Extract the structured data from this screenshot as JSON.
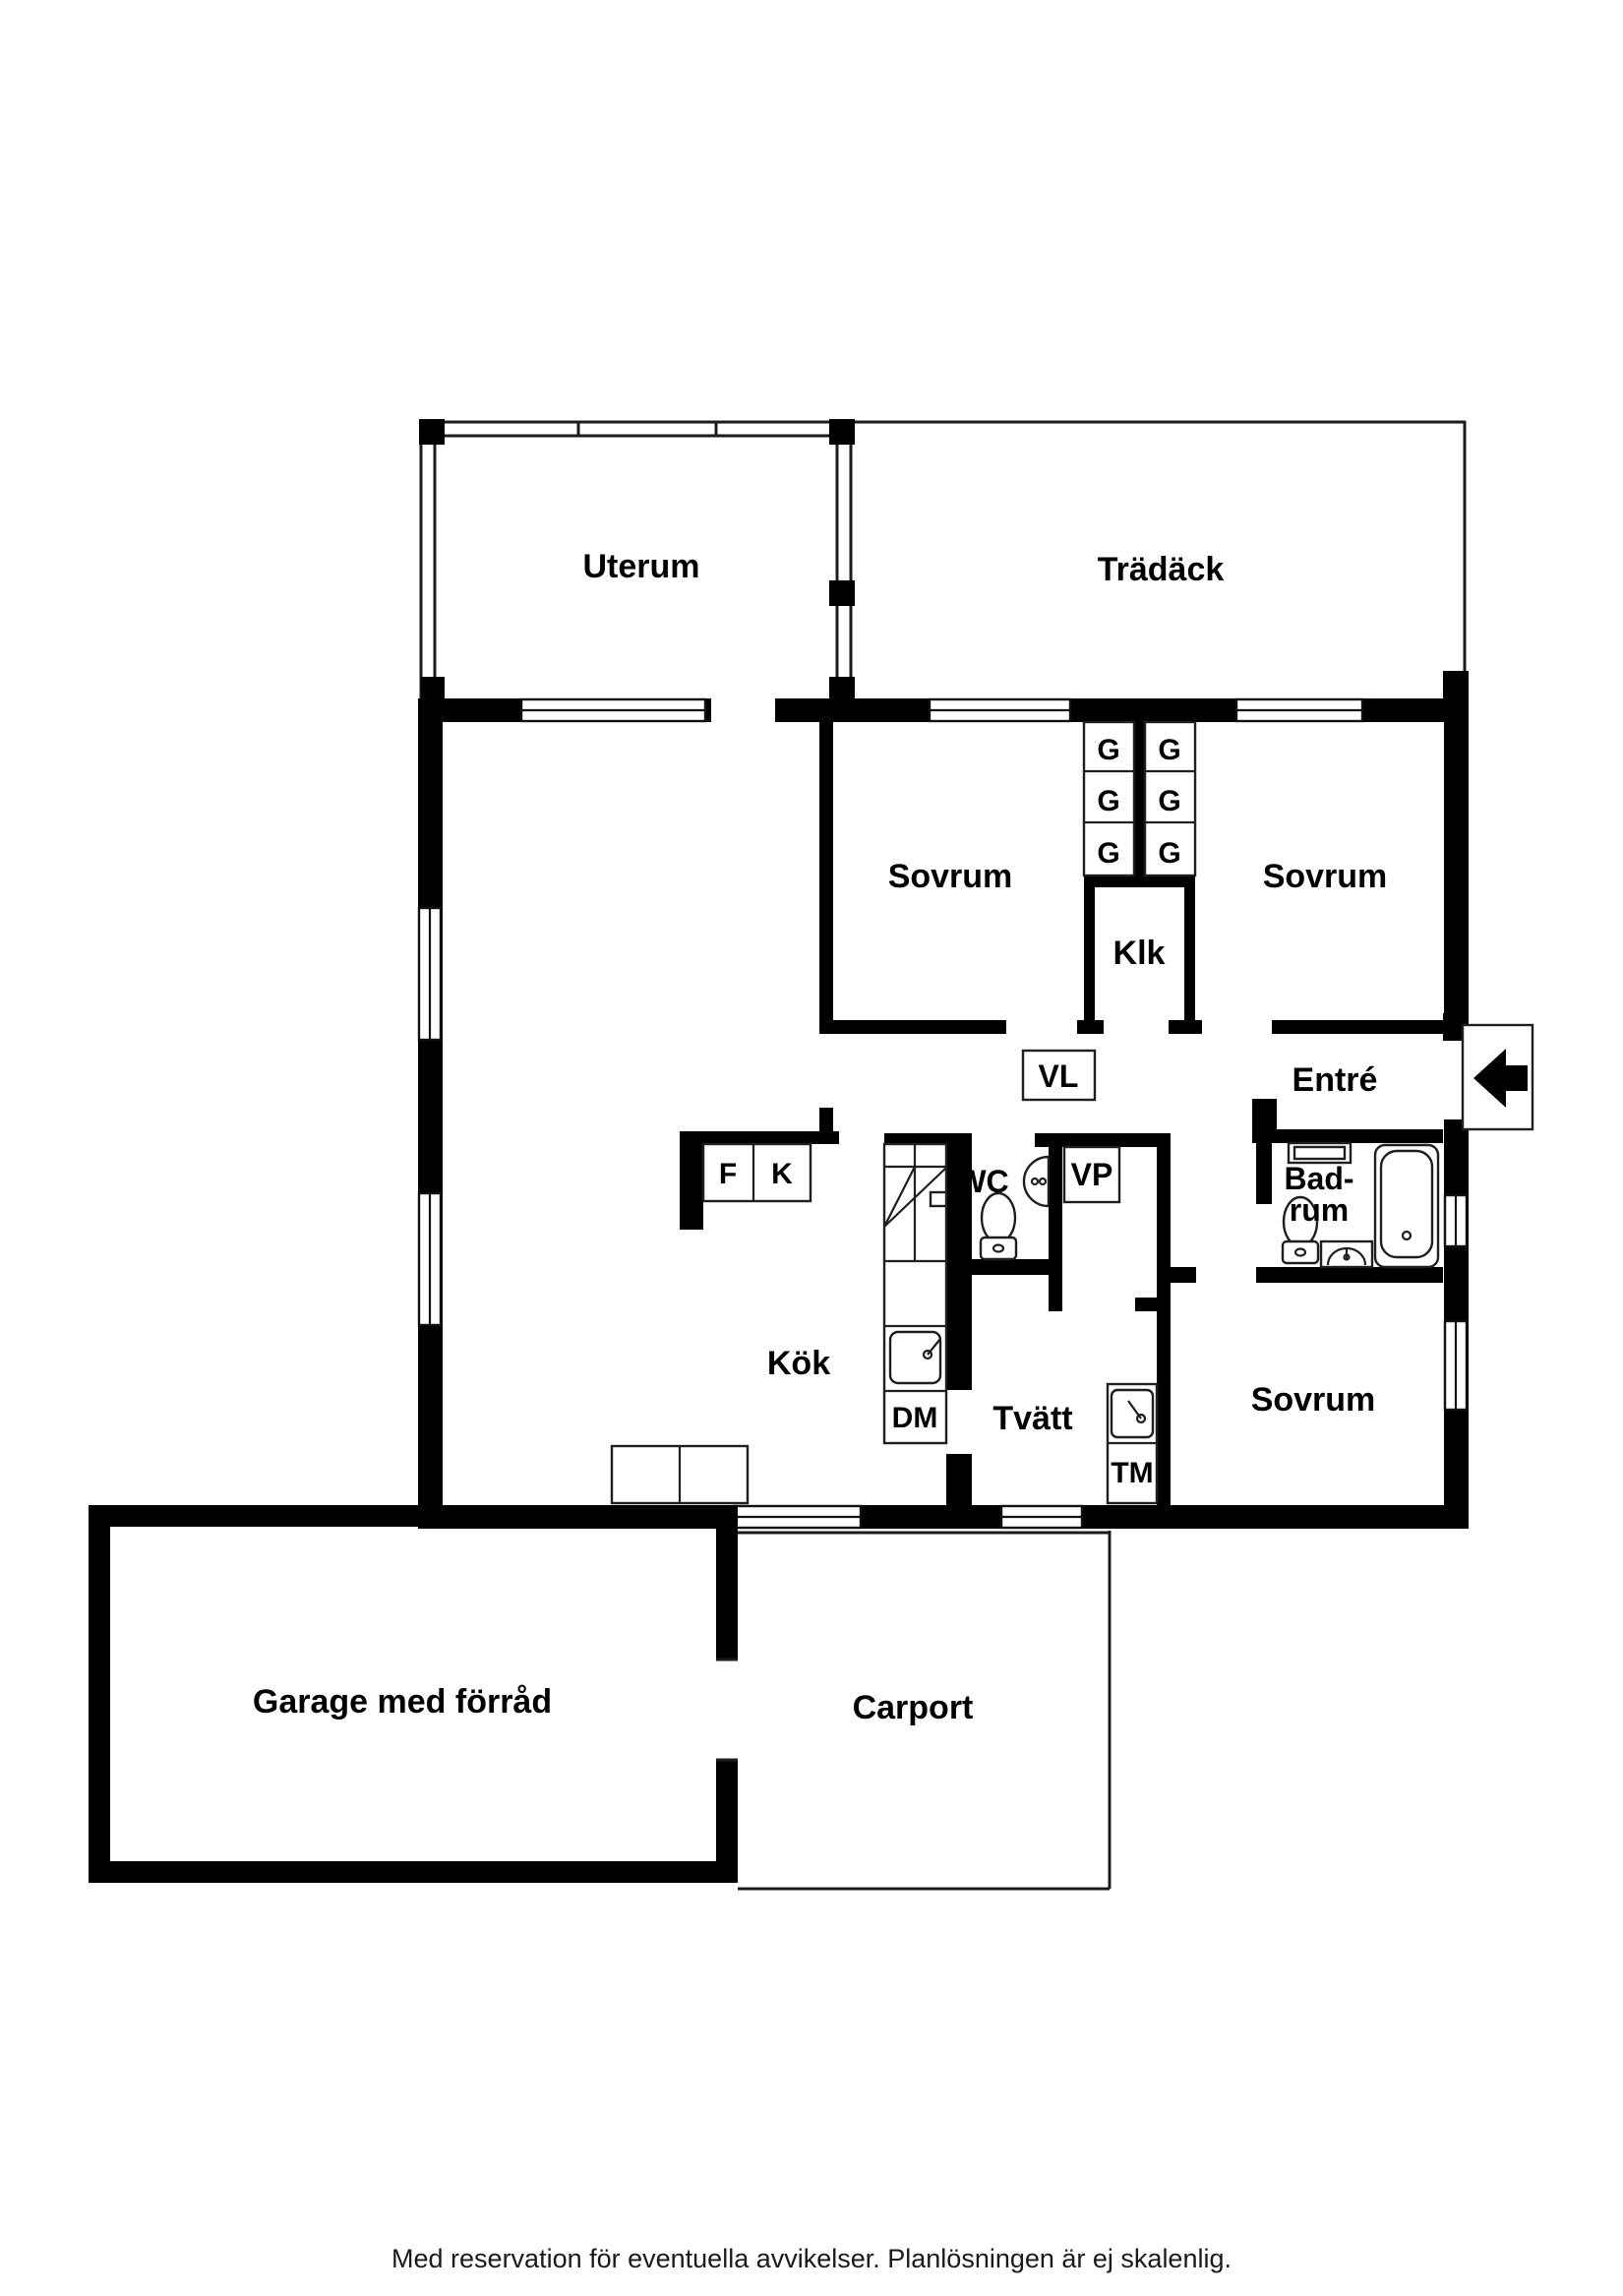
{
  "colors": {
    "background": "#ffffff",
    "walls": "#000000",
    "thin_lines": "#1c1c1c"
  },
  "plan": {
    "rooms": {
      "uterum": {
        "label": "Uterum"
      },
      "tradack": {
        "label": "Trädäck"
      },
      "sovrum_top_left": {
        "label": "Sovrum"
      },
      "sovrum_top_right": {
        "label": "Sovrum"
      },
      "sovrum_bottom": {
        "label": "Sovrum"
      },
      "klk": {
        "label": "Klk"
      },
      "entre": {
        "label": "Entré"
      },
      "badrum": {
        "line1": "Bad-",
        "line2": "rum"
      },
      "kok": {
        "label": "Kök"
      },
      "tvatt": {
        "label": "Tvätt"
      },
      "wc": {
        "label": "WC"
      },
      "garage": {
        "label": "Garage med förråd"
      },
      "carport": {
        "label": "Carport"
      }
    },
    "fixtures": {
      "vl": "VL",
      "vp": "VP",
      "fridge": "F",
      "freezer": "K",
      "dishwasher": "DM",
      "washing_machine": "TM",
      "wardrobes": [
        "G",
        "G",
        "G",
        "G",
        "G",
        "G"
      ]
    }
  },
  "footer": {
    "disclaimer": "Med reservation för eventuella avvikelser. Planlösningen är ej skalenlig."
  }
}
